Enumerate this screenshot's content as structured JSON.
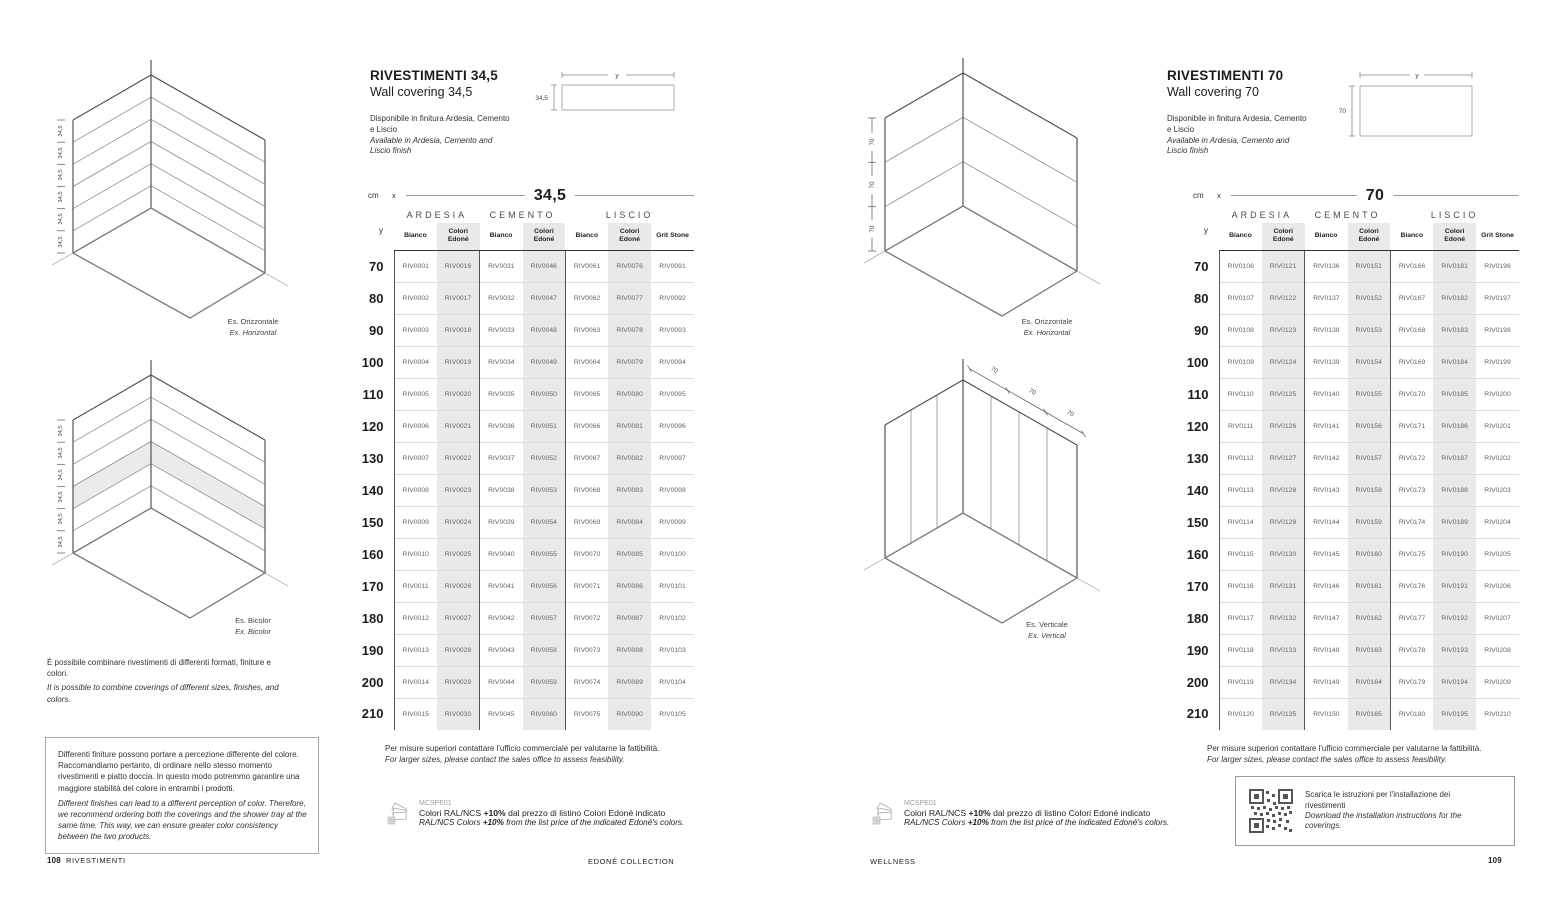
{
  "shared": {
    "unit": "cm",
    "x_label": "x",
    "y_label": "y",
    "larger_it": "Per misure superiori contattare l'ufficio commerciale per valutarne la fattibilità.",
    "larger_en": "For larger sizes, please contact the sales office to assess feasibility.",
    "mcspe": {
      "code": "MCSPE01",
      "it_pre": "Colori RAL/NCS ",
      "it_bold": "+10%",
      "it_post": " dal prezzo di listino Colori Edoné indicato",
      "en_pre": "RAL/NCS Colors ",
      "en_bold": "+10%",
      "en_post": " from the list price of the indicated Edoné's colors."
    }
  },
  "left_page": {
    "title": "RIVESTIMENTI 34,5",
    "subtitle": "Wall covering 34,5",
    "avail_it": "Disponibile in finitura Ardesia, Cemento e Liscio",
    "avail_en": "Available in Ardesia, Cemento and Liscio finish",
    "dim": "34,5",
    "captions": {
      "d1_it": "Es. Orizzontale",
      "d1_en": "Ex. Horizontal",
      "d2_it": "Es. Bicolor",
      "d2_en": "Ex. Bicolor"
    },
    "combine_it": "È possibile combinare rivestimenti di differenti formati, finiture e colori.",
    "combine_en": "It is possible to combine coverings of different sizes, finishes, and colors.",
    "warning_it": "Differenti finiture possono portare a percezione differente del colore. Raccomandiamo pertanto, di ordinare nello stesso momento rivestimenti e piatto doccia. In questo modo potremmo garantire una maggiore stabilità del colore in entrambi i prodotti.",
    "warning_en": "Different finishes can lead to a different perception of color. Therefore, we recommend ordering both the coverings and the shower tray at the same time. This way, we can ensure greater color consistency between the two products.",
    "table": {
      "size_title": "34,5",
      "groups": [
        {
          "label": "ARDESIA",
          "span": 2
        },
        {
          "label": "CEMENTO",
          "span": 2
        },
        {
          "label": "LISCIO",
          "span": 3
        }
      ],
      "columns": [
        [
          "Bianco"
        ],
        [
          "Colori",
          "Edoné"
        ],
        [
          "Bianco"
        ],
        [
          "Colori",
          "Edoné"
        ],
        [
          "Bianco"
        ],
        [
          "Colori",
          "Edoné"
        ],
        [
          "Grit Stone"
        ]
      ],
      "shaded_columns": [
        1,
        3,
        5
      ],
      "rows": [
        {
          "y": "70",
          "codes": [
            "RIV0001",
            "RIV0016",
            "RIV0031",
            "RIV0046",
            "RIV0061",
            "RIV0076",
            "RIV0091"
          ]
        },
        {
          "y": "80",
          "codes": [
            "RIV0002",
            "RIV0017",
            "RIV0032",
            "RIV0047",
            "RIV0062",
            "RIV0077",
            "RIV0092"
          ]
        },
        {
          "y": "90",
          "codes": [
            "RIV0003",
            "RIV0018",
            "RIV0033",
            "RIV0048",
            "RIV0063",
            "RIV0078",
            "RIV0093"
          ]
        },
        {
          "y": "100",
          "codes": [
            "RIV0004",
            "RIV0019",
            "RIV0034",
            "RIV0049",
            "RIV0064",
            "RIV0079",
            "RIV0094"
          ]
        },
        {
          "y": "110",
          "codes": [
            "RIV0005",
            "RIV0020",
            "RIV0035",
            "RIV0050",
            "RIV0065",
            "RIV0080",
            "RIV0095"
          ]
        },
        {
          "y": "120",
          "codes": [
            "RIV0006",
            "RIV0021",
            "RIV0036",
            "RIV0051",
            "RIV0066",
            "RIV0081",
            "RIV0096"
          ]
        },
        {
          "y": "130",
          "codes": [
            "RIV0007",
            "RIV0022",
            "RIV0037",
            "RIV0052",
            "RIV0067",
            "RIV0082",
            "RIV0097"
          ]
        },
        {
          "y": "140",
          "codes": [
            "RIV0008",
            "RIV0023",
            "RIV0038",
            "RIV0053",
            "RIV0068",
            "RIV0083",
            "RIV0098"
          ]
        },
        {
          "y": "150",
          "codes": [
            "RIV0009",
            "RIV0024",
            "RIV0039",
            "RIV0054",
            "RIV0069",
            "RIV0084",
            "RIV0099"
          ]
        },
        {
          "y": "160",
          "codes": [
            "RIV0010",
            "RIV0025",
            "RIV0040",
            "RIV0055",
            "RIV0070",
            "RIV0085",
            "RIV0100"
          ]
        },
        {
          "y": "170",
          "codes": [
            "RIV0011",
            "RIV0026",
            "RIV0041",
            "RIV0056",
            "RIV0071",
            "RIV0086",
            "RIV0101"
          ]
        },
        {
          "y": "180",
          "codes": [
            "RIV0012",
            "RIV0027",
            "RIV0042",
            "RIV0057",
            "RIV0072",
            "RIV0087",
            "RIV0102"
          ]
        },
        {
          "y": "190",
          "codes": [
            "RIV0013",
            "RIV0028",
            "RIV0043",
            "RIV0058",
            "RIV0073",
            "RIV0088",
            "RIV0103"
          ]
        },
        {
          "y": "200",
          "codes": [
            "RIV0014",
            "RIV0029",
            "RIV0044",
            "RIV0059",
            "RIV0074",
            "RIV0089",
            "RIV0104"
          ]
        },
        {
          "y": "210",
          "codes": [
            "RIV0015",
            "RIV0030",
            "RIV0045",
            "RIV0060",
            "RIV0075",
            "RIV0090",
            "RIV0105"
          ]
        }
      ]
    }
  },
  "right_page": {
    "title": "RIVESTIMENTI 70",
    "subtitle": "Wall covering 70",
    "avail_it": "Disponibile in finitura Ardesia, Cemento e Liscio",
    "avail_en": "Available in Ardesia, Cemento and Liscio finish",
    "dim": "70",
    "captions": {
      "d1_it": "Es. Orizzontale",
      "d1_en": "Ex. Horizontal",
      "d2_it": "Es. Verticale",
      "d2_en": "Ex. Vertical"
    },
    "qr_it": "Scarica le istruzioni per l'installazione dei rivestimenti",
    "qr_en": "Download the installation instructions for the coverings.",
    "table": {
      "size_title": "70",
      "groups": [
        {
          "label": "ARDESIA",
          "span": 2
        },
        {
          "label": "CEMENTO",
          "span": 2
        },
        {
          "label": "LISCIO",
          "span": 3
        }
      ],
      "columns": [
        [
          "Bianco"
        ],
        [
          "Colori",
          "Edoné"
        ],
        [
          "Bianco"
        ],
        [
          "Colori",
          "Edoné"
        ],
        [
          "Bianco"
        ],
        [
          "Colori",
          "Edoné"
        ],
        [
          "Grit Stone"
        ]
      ],
      "shaded_columns": [
        1,
        3,
        5
      ],
      "rows": [
        {
          "y": "70",
          "codes": [
            "RIV0106",
            "RIV0121",
            "RIV0136",
            "RIV0151",
            "RIV0166",
            "RIV0181",
            "RIV0196"
          ]
        },
        {
          "y": "80",
          "codes": [
            "RIV0107",
            "RIV0122",
            "RIV0137",
            "RIV0152",
            "RIV0167",
            "RIV0182",
            "RIV0197"
          ]
        },
        {
          "y": "90",
          "codes": [
            "RIV0108",
            "RIV0123",
            "RIV0138",
            "RIV0153",
            "RIV0168",
            "RIV0183",
            "RIV0198"
          ]
        },
        {
          "y": "100",
          "codes": [
            "RIV0109",
            "RIV0124",
            "RIV0139",
            "RIV0154",
            "RIV0169",
            "RIV0184",
            "RIV0199"
          ]
        },
        {
          "y": "110",
          "codes": [
            "RIV0110",
            "RIV0125",
            "RIV0140",
            "RIV0155",
            "RIV0170",
            "RIV0185",
            "RIV0200"
          ]
        },
        {
          "y": "120",
          "codes": [
            "RIV0111",
            "RIV0126",
            "RIV0141",
            "RIV0156",
            "RIV0171",
            "RIV0186",
            "RIV0201"
          ]
        },
        {
          "y": "130",
          "codes": [
            "RIV0112",
            "RIV0127",
            "RIV0142",
            "RIV0157",
            "RIV0172",
            "RIV0187",
            "RIV0202"
          ]
        },
        {
          "y": "140",
          "codes": [
            "RIV0113",
            "RIV0128",
            "RIV0143",
            "RIV0158",
            "RIV0173",
            "RIV0188",
            "RIV0203"
          ]
        },
        {
          "y": "150",
          "codes": [
            "RIV0114",
            "RIV0129",
            "RIV0144",
            "RIV0159",
            "RIV0174",
            "RIV0189",
            "RIV0204"
          ]
        },
        {
          "y": "160",
          "codes": [
            "RIV0115",
            "RIV0130",
            "RIV0145",
            "RIV0160",
            "RIV0175",
            "RIV0190",
            "RIV0205"
          ]
        },
        {
          "y": "170",
          "codes": [
            "RIV0116",
            "RIV0131",
            "RIV0146",
            "RIV0161",
            "RIV0176",
            "RIV0191",
            "RIV0206"
          ]
        },
        {
          "y": "180",
          "codes": [
            "RIV0117",
            "RIV0132",
            "RIV0147",
            "RIV0162",
            "RIV0177",
            "RIV0192",
            "RIV0207"
          ]
        },
        {
          "y": "190",
          "codes": [
            "RIV0118",
            "RIV0133",
            "RIV0148",
            "RIV0163",
            "RIV0178",
            "RIV0193",
            "RIV0208"
          ]
        },
        {
          "y": "200",
          "codes": [
            "RIV0119",
            "RIV0134",
            "RIV0149",
            "RIV0164",
            "RIV0179",
            "RIV0194",
            "RIV0209"
          ]
        },
        {
          "y": "210",
          "codes": [
            "RIV0120",
            "RIV0135",
            "RIV0150",
            "RIV0165",
            "RIV0180",
            "RIV0195",
            "RIV0210"
          ]
        }
      ]
    }
  },
  "footer": {
    "page_left": "108",
    "section_left": "RIVESTIMENTI",
    "collection": "EDONÉ COLLECTION",
    "section_right": "WELLNESS",
    "page_right": "109"
  }
}
